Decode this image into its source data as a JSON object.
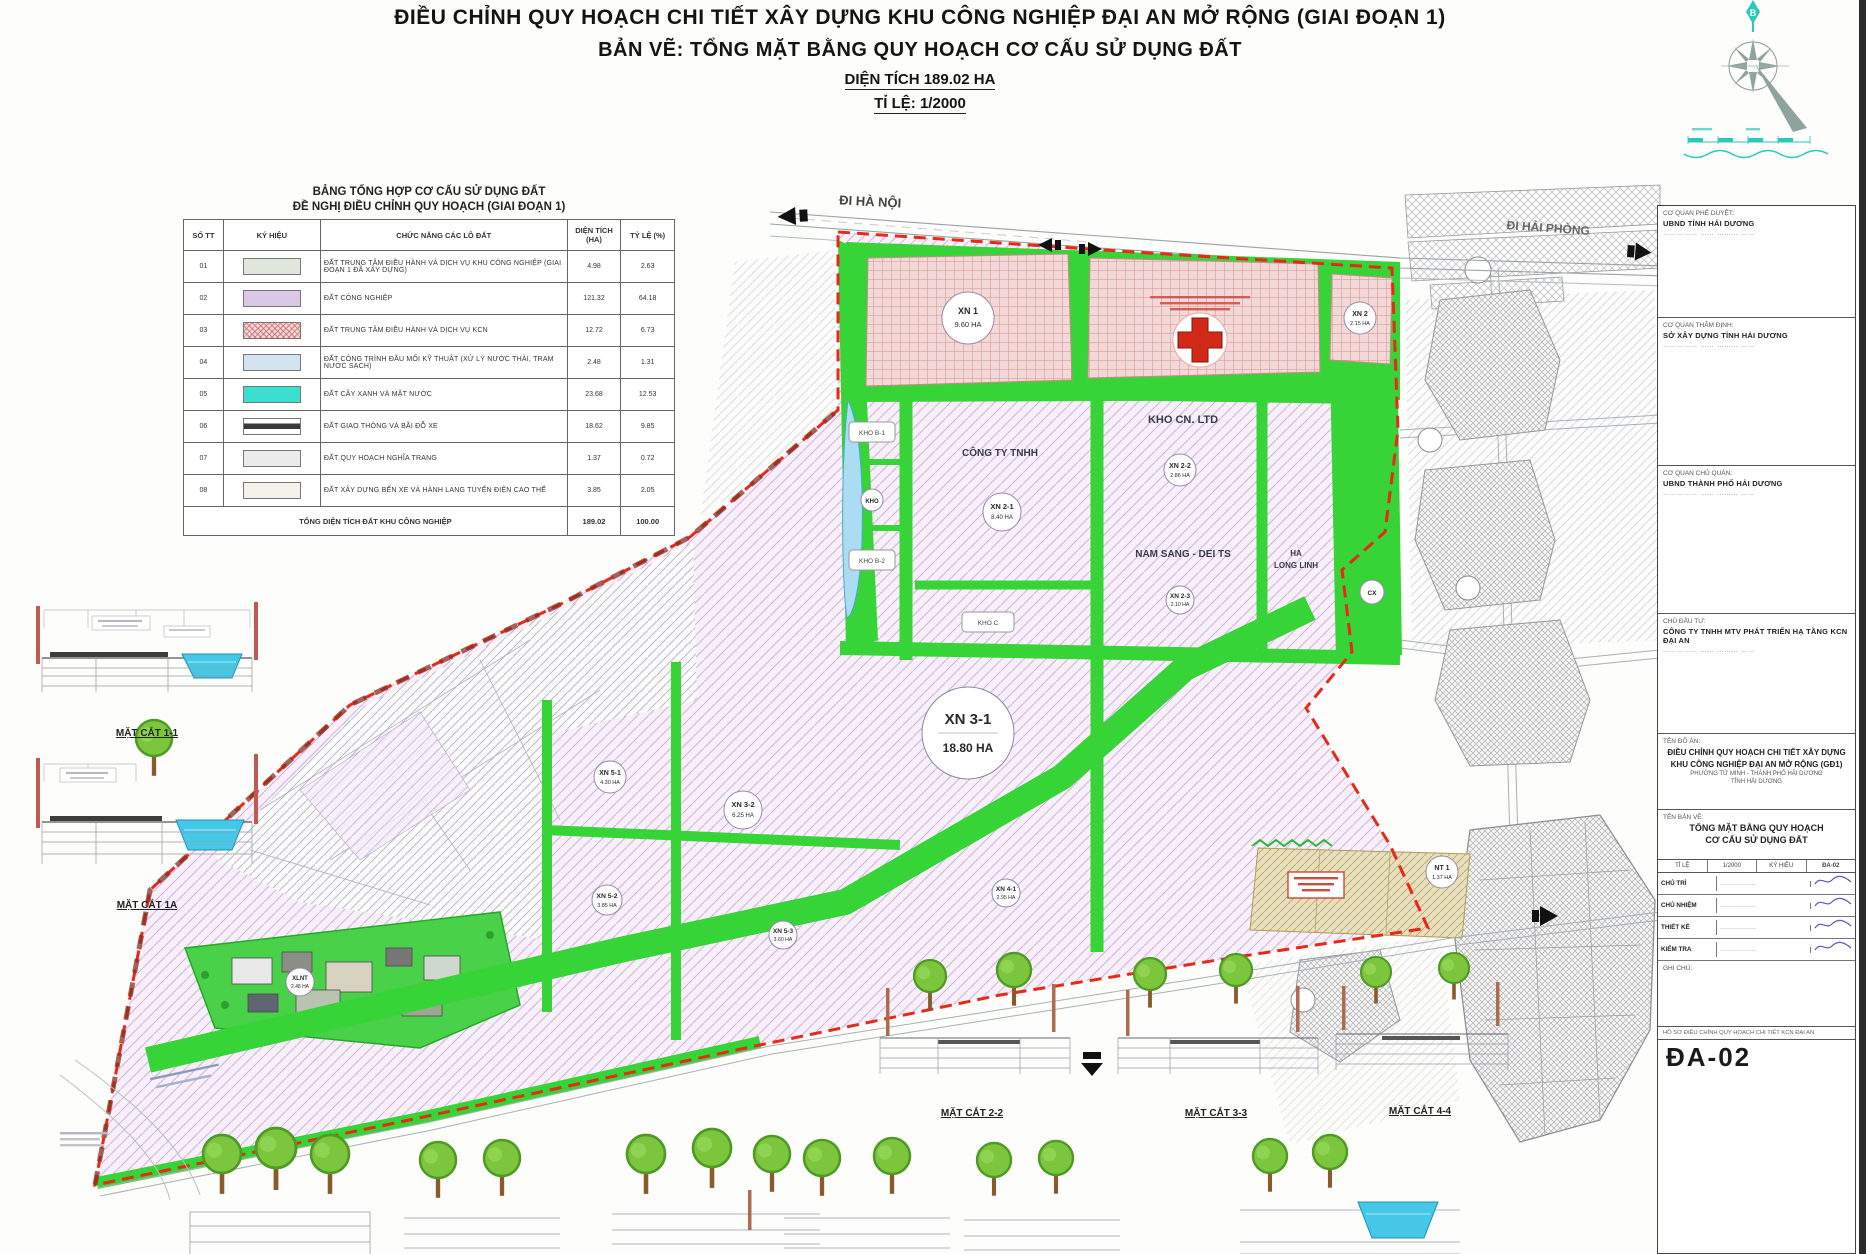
{
  "header": {
    "line1": "ĐIỀU CHỈNH QUY HOẠCH CHI TIẾT XÂY DỰNG KHU CÔNG NGHIỆP ĐẠI AN MỞ RỘNG (GIAI ĐOẠN 1)",
    "line2": "BẢN VẼ: TỔNG MẶT BẰNG QUY HOẠCH CƠ CẤU SỬ DỤNG ĐẤT",
    "line3": "DIỆN TÍCH 189.02 HA",
    "line4": "TỈ LỆ: 1/2000"
  },
  "legend": {
    "title1": "BẢNG TỔNG HỢP CƠ CẤU SỬ DỤNG ĐẤT",
    "title2": "ĐỀ NGHỊ ĐIỀU CHỈNH QUY HOẠCH (GIAI ĐOẠN 1)",
    "columns": [
      "SỐ TT",
      "KÝ HIỆU",
      "CHỨC NĂNG CÁC LÔ ĐẤT",
      "DIỆN TÍCH (HA)",
      "TỶ LỆ (%)"
    ],
    "rows": [
      {
        "stt": "01",
        "sw": "admin",
        "label": "ĐẤT TRUNG TÂM ĐIỀU HÀNH VÀ DỊCH VỤ KHU CÔNG NGHIỆP (GIAI ĐOẠN 1 ĐÃ XÂY DỰNG)",
        "area": "4.98",
        "pct": "2.63"
      },
      {
        "stt": "02",
        "sw": "cn",
        "label": "ĐẤT CÔNG NGHIỆP",
        "area": "121.32",
        "pct": "64.18"
      },
      {
        "stt": "03",
        "sw": "dv",
        "label": "ĐẤT TRUNG TÂM ĐIỀU HÀNH VÀ DỊCH VỤ KCN",
        "area": "12.72",
        "pct": "6.73"
      },
      {
        "stt": "04",
        "sw": "kt",
        "label": "ĐẤT CÔNG TRÌNH ĐẦU MỐI KỸ THUẬT (XỬ LÝ NƯỚC THẢI, TRẠM NƯỚC SẠCH)",
        "area": "2.48",
        "pct": "1.31"
      },
      {
        "stt": "05",
        "sw": "mn",
        "label": "ĐẤT CÂY XANH VÀ MẶT NƯỚC",
        "area": "23.68",
        "pct": "12.53"
      },
      {
        "stt": "06",
        "sw": "gt",
        "label": "ĐẤT GIAO THÔNG VÀ BÃI ĐỖ XE",
        "area": "18.62",
        "pct": "9.85"
      },
      {
        "stt": "07",
        "sw": "nt",
        "label": "ĐẤT QUY HOẠCH NGHĨA TRANG",
        "area": "1.37",
        "pct": "0.72"
      },
      {
        "stt": "08",
        "sw": "kh",
        "label": "ĐẤT XÂY DỰNG BẾN XE VÀ HÀNH LANG TUYẾN ĐIỆN CAO THẾ",
        "area": "3.85",
        "pct": "2.05"
      }
    ],
    "total_label": "TỔNG DIỆN TÍCH ĐẤT KHU CÔNG NGHIỆP",
    "total_area": "189.02",
    "total_pct": "100.00"
  },
  "map": {
    "dir_hanoi": "ĐI HÀ NỘI",
    "dir_haiphong": "ĐI HẢI PHÒNG",
    "compass_north": "B",
    "zones": [
      {
        "code": "XN 1",
        "area": "9.60 HA"
      },
      {
        "code": "XN 2",
        "area": "2.15 HA"
      },
      {
        "code": "XN 2-1",
        "area": "8.40 HA"
      },
      {
        "code": "XN 2-2",
        "area": "2.86 HA"
      },
      {
        "code": "XN 2-3",
        "area": "2.10 HA"
      },
      {
        "code": "XN 3-1",
        "area": "18.80 HA"
      },
      {
        "code": "XN 3-2",
        "area": "6.25 HA"
      },
      {
        "code": "XN 5-1",
        "area": "4.30 HA"
      },
      {
        "code": "XN 5-2",
        "area": "3.85 HA"
      },
      {
        "code": "XN 5-3",
        "area": "3.60 HA"
      },
      {
        "code": "XN 4-1",
        "area": "2.95 HA"
      },
      {
        "code": "NT 1",
        "area": "1.37 HA"
      },
      {
        "code": "XLNT",
        "area": "2.48 HA"
      },
      {
        "code": "CX",
        "area": ""
      },
      {
        "code": "KHO",
        "area": ""
      }
    ],
    "lots": {
      "kho_cn": "KHO CN. LTD",
      "nam_sang": "NAM SANG - DEI TS",
      "ha1": "HA",
      "ha2": "LONG LINH",
      "cty": "CÔNG TY TNHH",
      "kho_b1": "KHO B-1",
      "kho_b2": "KHO B-2",
      "kho_c": "KHO C"
    },
    "sections": {
      "s11": "MẶT CẮT 1-1",
      "s1a": "MẶT CẮT 1A",
      "s22": "MẶT CẮT 2-2",
      "s33": "MẶT CẮT 3-3",
      "s44": "MẶT CẮT 4-4"
    }
  },
  "titleblock": {
    "boxes": [
      {
        "label": "CƠ QUAN PHÊ DUYỆT:",
        "bold": "UBND TỈNH HẢI DƯƠNG",
        "fields": "……………   ……   ………   ……"
      },
      {
        "label": "CƠ QUAN THẨM ĐỊNH:",
        "bold": "SỞ XÂY DỰNG TỈNH HẢI DƯƠNG",
        "fields": "……………   ……   ………   ……"
      },
      {
        "label": "CƠ QUAN CHỦ QUẢN:",
        "bold": "UBND THÀNH PHỐ HẢI DƯƠNG",
        "fields": "……………   ……   ………   ……"
      },
      {
        "label": "CHỦ ĐẦU TƯ:",
        "bold": "CÔNG TY TNHH MTV PHÁT TRIỂN HẠ TẦNG KCN ĐẠI AN",
        "fields": "……………   ……   ………   ……"
      }
    ],
    "project": {
      "label": "TÊN ĐỒ ÁN:",
      "line1": "ĐIỀU CHỈNH QUY HOẠCH CHI TIẾT XÂY DỰNG",
      "line2": "KHU CÔNG NGHIỆP ĐẠI AN MỞ RỘNG (GĐ1)",
      "loc1": "PHƯỜNG TỨ MINH - THÀNH PHỐ HẢI DƯƠNG",
      "loc2": "TỈNH HẢI DƯƠNG"
    },
    "drawing": {
      "label": "TÊN BẢN VẼ:",
      "line1": "TỔNG MẶT BẰNG QUY HOẠCH",
      "line2": "CƠ CẤU SỬ DỤNG ĐẤT"
    },
    "meta_row": [
      "TỈ LỆ",
      "1/2000",
      "KÝ HIỆU",
      "ĐA-02"
    ],
    "sign_rows": [
      {
        "role": "CHỦ TRÌ",
        "name": "………………"
      },
      {
        "role": "CHỦ NHIỆM",
        "name": "………………"
      },
      {
        "role": "THIẾT KẾ",
        "name": "………………"
      },
      {
        "role": "KIỂM TRA",
        "name": "………………"
      }
    ],
    "note_label": "GHI CHÚ:",
    "small_row": "HỒ SƠ ĐIỀU CHỈNH QUY HOẠCH CHI TIẾT KCN ĐẠI AN",
    "sheet_no": "ĐA-02"
  }
}
